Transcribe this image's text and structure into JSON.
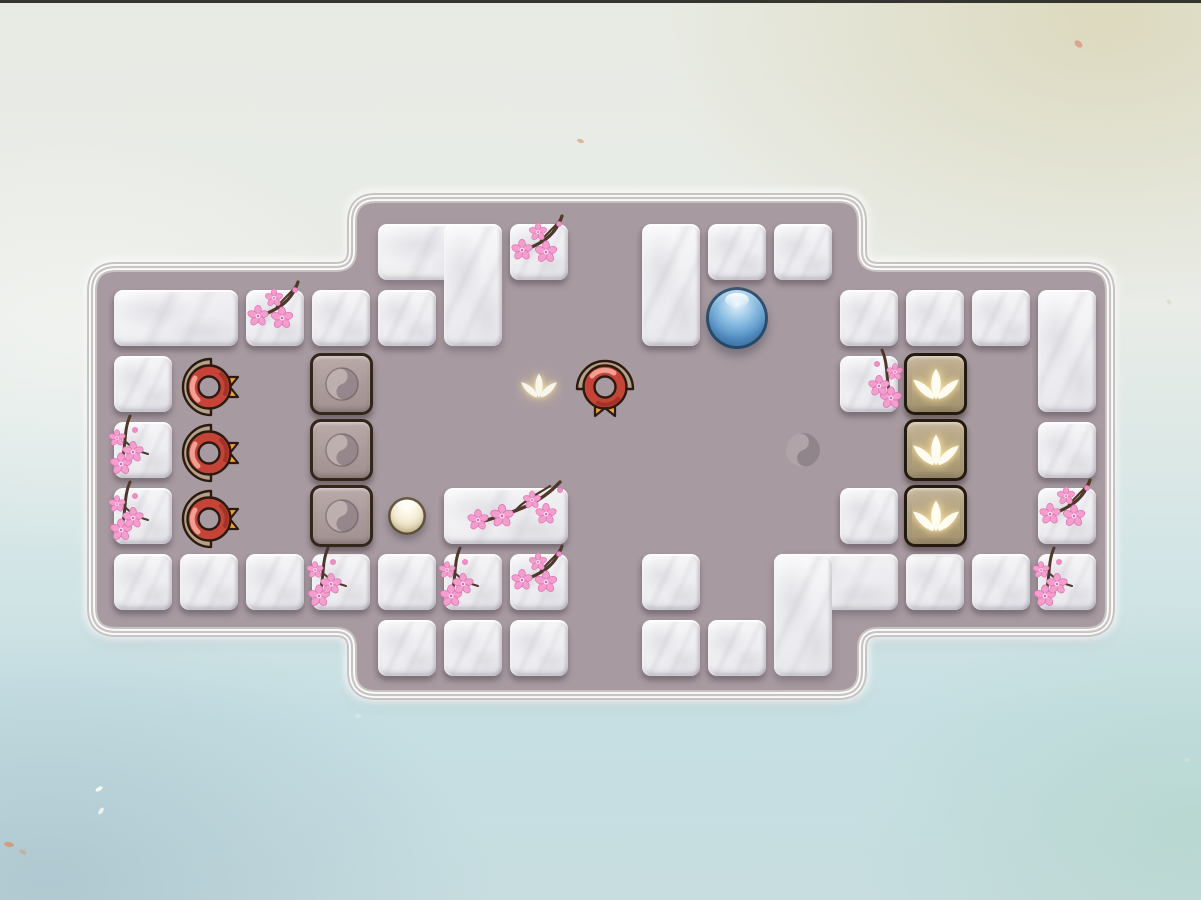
{
  "scene": {
    "kind": "zen-sliding-puzzle-level",
    "top_edge_color": "#35342f"
  },
  "palette": {
    "floor": "#a79aa0",
    "border_white": "#fbfbfa",
    "border_gray": "#c7c3c1",
    "inner_line": "rgba(108,94,102,0.35)",
    "marble_light": "#fbfbfc",
    "marble_dark": "#e6e6eb",
    "block_border": "#33261b",
    "lotus_tile_border": "#241a0f",
    "badge_ring": "#c64337",
    "badge_arc": "#b3a287",
    "badge_outline": "#2c1a11",
    "badge_ribbon_start": "#d96327",
    "badge_ribbon_end": "#f6b52c",
    "ball_blue": "#5b98cc",
    "pearl": "#efe5c8",
    "blossom_pink": "#f49ecd",
    "blossom_edge": "#dd6fb2",
    "branch_brown": "#4e382a",
    "lotus_white": "#fffdf2",
    "yin_light": "#c0b3b1",
    "yin_dark": "#92848a",
    "bg_top_left": "#e8ebe4",
    "bg_top_right": "#dbdccb",
    "bg_bottom": "#c6dfe3"
  },
  "grid": {
    "origin_x": 114,
    "origin_y": 224,
    "pitch": 66,
    "tile_w": 58,
    "tile_h": 56
  },
  "board_shape": {
    "outer_left": 92,
    "outer_right": 1110,
    "middle_left": 352,
    "middle_right": 862,
    "middle_top": 198,
    "middle_bottom": 695,
    "side_top": 267,
    "side_bottom": 632,
    "corner_radius": 24,
    "step_radius": 16
  },
  "tiles": [
    {
      "kind": "marble",
      "c": 0,
      "r": 1,
      "w": 2,
      "h": 1,
      "decor": null
    },
    {
      "kind": "marble",
      "c": 2,
      "r": 1,
      "w": 1,
      "h": 1,
      "decor": "a"
    },
    {
      "kind": "marble",
      "c": 3,
      "r": 1,
      "w": 1,
      "h": 1,
      "decor": null
    },
    {
      "kind": "marble",
      "c": 0,
      "r": 2,
      "w": 1,
      "h": 1,
      "decor": null
    },
    {
      "kind": "marble",
      "c": 0,
      "r": 3,
      "w": 1,
      "h": 1,
      "decor": "b"
    },
    {
      "kind": "marble",
      "c": 0,
      "r": 4,
      "w": 1,
      "h": 1,
      "decor": "b"
    },
    {
      "kind": "marble",
      "c": 0,
      "r": 5,
      "w": 1,
      "h": 1,
      "decor": null
    },
    {
      "kind": "marble",
      "c": 1,
      "r": 5,
      "w": 1,
      "h": 1,
      "decor": null
    },
    {
      "kind": "marble",
      "c": 2,
      "r": 5,
      "w": 1,
      "h": 1,
      "decor": null
    },
    {
      "kind": "marble",
      "c": 3,
      "r": 5,
      "w": 1,
      "h": 1,
      "decor": "b"
    },
    {
      "kind": "marble",
      "c": 4,
      "r": 5,
      "w": 1,
      "h": 1,
      "decor": null
    },
    {
      "kind": "marble",
      "c": 5,
      "r": 5,
      "w": 1,
      "h": 1,
      "decor": "b"
    },
    {
      "kind": "marble",
      "c": 6,
      "r": 5,
      "w": 1,
      "h": 1,
      "decor": "a"
    },
    {
      "kind": "marble",
      "c": 4,
      "r": 6,
      "w": 1,
      "h": 1,
      "decor": null
    },
    {
      "kind": "marble",
      "c": 5,
      "r": 6,
      "w": 1,
      "h": 1,
      "decor": null
    },
    {
      "kind": "marble",
      "c": 6,
      "r": 6,
      "w": 1,
      "h": 1,
      "decor": null
    },
    {
      "kind": "marble",
      "c": 8,
      "r": 5,
      "w": 1,
      "h": 1,
      "decor": null
    },
    {
      "kind": "marble",
      "c": 8,
      "r": 6,
      "w": 1,
      "h": 1,
      "decor": null
    },
    {
      "kind": "marble",
      "c": 9,
      "r": 6,
      "w": 1,
      "h": 1,
      "decor": null
    },
    {
      "kind": "marble",
      "c": 4,
      "r": 0,
      "shape": "L",
      "legs": "bar-top-right-leg",
      "decor": null
    },
    {
      "kind": "marble",
      "c": 4,
      "r": 1,
      "w": 1,
      "h": 1,
      "decor": null
    },
    {
      "kind": "marble",
      "c": 6,
      "r": 0,
      "w": 1,
      "h": 1,
      "decor": "a"
    },
    {
      "kind": "marble",
      "c": 8,
      "r": 0,
      "w": 1,
      "h": 2,
      "decor": null
    },
    {
      "kind": "marble",
      "c": 9,
      "r": 0,
      "w": 1,
      "h": 1,
      "decor": null
    },
    {
      "kind": "marble",
      "c": 10,
      "r": 0,
      "w": 1,
      "h": 1,
      "decor": null
    },
    {
      "kind": "marble",
      "c": 5,
      "r": 4,
      "w": 2,
      "h": 1,
      "decor": "wide"
    },
    {
      "kind": "marble",
      "c": 10,
      "r": 5,
      "shape": "L",
      "legs": "bar-top-left-leg",
      "decor": null
    },
    {
      "kind": "marble",
      "c": 11,
      "r": 1,
      "w": 1,
      "h": 1,
      "decor": null
    },
    {
      "kind": "marble",
      "c": 12,
      "r": 1,
      "w": 1,
      "h": 1,
      "decor": null
    },
    {
      "kind": "marble",
      "c": 13,
      "r": 1,
      "w": 1,
      "h": 1,
      "decor": null
    },
    {
      "kind": "marble",
      "c": 14,
      "r": 1,
      "w": 1,
      "h": 2,
      "decor": null
    },
    {
      "kind": "marble",
      "c": 11,
      "r": 2,
      "w": 1,
      "h": 1,
      "decor": "bm"
    },
    {
      "kind": "marble",
      "c": 14,
      "r": 3,
      "w": 1,
      "h": 1,
      "decor": null
    },
    {
      "kind": "marble",
      "c": 11,
      "r": 4,
      "w": 1,
      "h": 1,
      "decor": null
    },
    {
      "kind": "marble",
      "c": 14,
      "r": 4,
      "w": 1,
      "h": 1,
      "decor": "a"
    },
    {
      "kind": "marble",
      "c": 12,
      "r": 5,
      "w": 1,
      "h": 1,
      "decor": null
    },
    {
      "kind": "marble",
      "c": 13,
      "r": 5,
      "w": 1,
      "h": 1,
      "decor": null
    },
    {
      "kind": "marble",
      "c": 14,
      "r": 5,
      "w": 1,
      "h": 1,
      "decor": "b"
    },
    {
      "kind": "yin",
      "c": 3,
      "r": 2
    },
    {
      "kind": "yin",
      "c": 3,
      "r": 3
    },
    {
      "kind": "yin",
      "c": 3,
      "r": 4
    },
    {
      "kind": "lotus",
      "c": 12,
      "r": 2
    },
    {
      "kind": "lotus",
      "c": 12,
      "r": 3
    },
    {
      "kind": "lotus",
      "c": 12,
      "r": 4
    }
  ],
  "markers": [
    {
      "type": "badge",
      "c": 1,
      "r": 2,
      "dir": "right"
    },
    {
      "type": "badge",
      "c": 1,
      "r": 3,
      "dir": "right"
    },
    {
      "type": "badge",
      "c": 1,
      "r": 4,
      "dir": "right"
    },
    {
      "type": "badge",
      "c": 7,
      "r": 2,
      "dir": "down"
    },
    {
      "type": "lotus-glyph",
      "c": 6,
      "r": 2
    },
    {
      "type": "yinyang-glyph",
      "c": 10,
      "r": 3
    }
  ],
  "balls": [
    {
      "type": "blue",
      "c": 9,
      "r": 1
    },
    {
      "type": "pearl",
      "c": 4,
      "r": 4
    }
  ],
  "petals": [
    {
      "x": 1074,
      "y": 41,
      "w": 9,
      "h": 6,
      "rot": 40,
      "color": "#d9987f",
      "op": 0.8
    },
    {
      "x": 577,
      "y": 139,
      "w": 7,
      "h": 4,
      "rot": 20,
      "color": "#d9a07e",
      "op": 0.7
    },
    {
      "x": 95,
      "y": 787,
      "w": 8,
      "h": 4,
      "rot": -30,
      "color": "#f4fbf8",
      "op": 0.95
    },
    {
      "x": 97,
      "y": 809,
      "w": 8,
      "h": 4,
      "rot": -55,
      "color": "#eef6f3",
      "op": 0.9
    },
    {
      "x": 4,
      "y": 842,
      "w": 10,
      "h": 5,
      "rot": 10,
      "color": "#cf9467",
      "op": 0.75
    },
    {
      "x": 19,
      "y": 850,
      "w": 8,
      "h": 4,
      "rot": 30,
      "color": "#c9a27c",
      "op": 0.6
    },
    {
      "x": 355,
      "y": 714,
      "w": 6,
      "h": 4,
      "rot": 0,
      "color": "#d8ebe4",
      "op": 0.7
    },
    {
      "x": 1166,
      "y": 300,
      "w": 6,
      "h": 4,
      "rot": 60,
      "color": "#d8d2bd",
      "op": 0.5
    },
    {
      "x": 40,
      "y": 298,
      "w": 5,
      "h": 4,
      "rot": 0,
      "color": "#eef1ed",
      "op": 0.8
    },
    {
      "x": 1184,
      "y": 758,
      "w": 6,
      "h": 4,
      "rot": -20,
      "color": "#cfe4dc",
      "op": 0.7
    }
  ],
  "icons": {
    "yin-yang-icon": "embossed yin-yang circle",
    "lotus-icon": "three-petal lotus",
    "badge-rosette-icon": "red ring with tan arc and orange ribbon",
    "cherry-blossom-icon": "pink five-petal blossom on branch"
  }
}
